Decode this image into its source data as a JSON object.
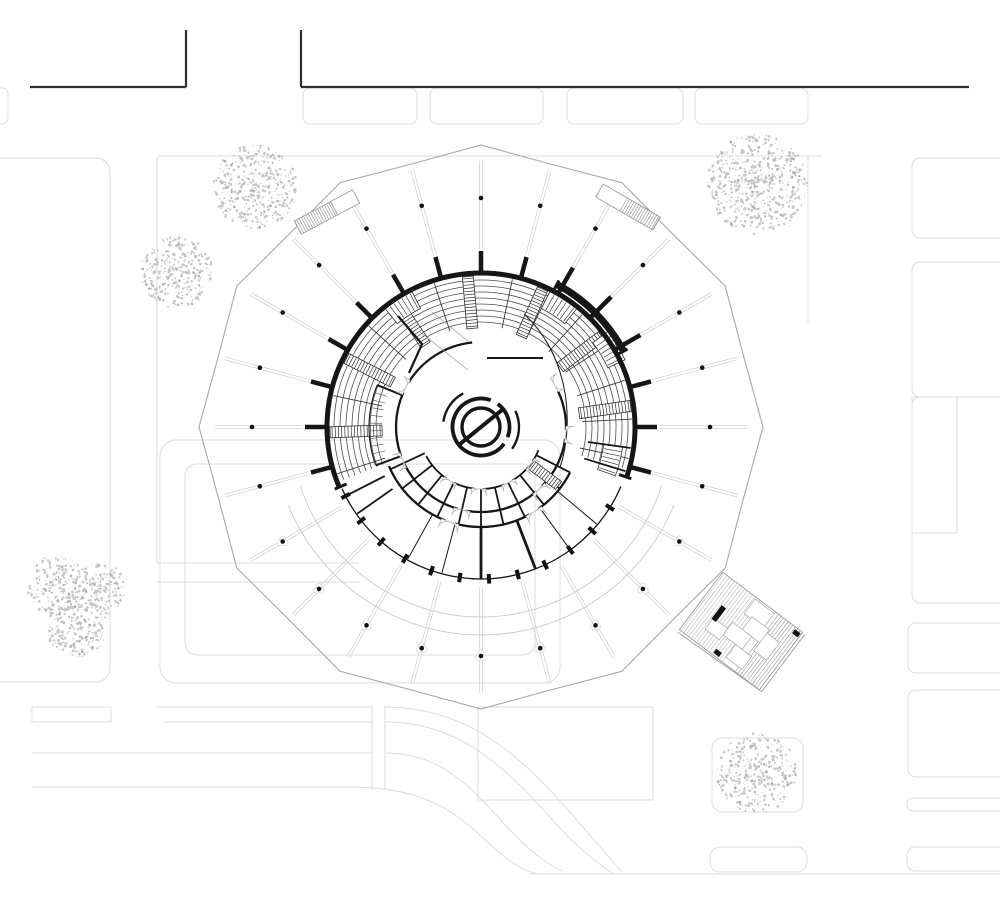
{
  "scene": {
    "canvas": {
      "w": 1000,
      "h": 913
    },
    "colors": {
      "ink": "#161616",
      "road": "#2f2f2f",
      "site": "#dcdcdc",
      "canopy": "#cfcfcf",
      "polygon": "#a8a8a8",
      "arc_faint": "#c9c9c9",
      "seat": "#4d4d4d",
      "sector": "#3a3a3a",
      "door": "#b5b5b5",
      "tree": "#c6c6c6",
      "tree_dark": "#b2b2b2",
      "annex": "#9a9a9a",
      "white": "#ffffff"
    },
    "center": {
      "x": 481,
      "y": 427
    },
    "roads": {
      "width": 2.2,
      "segments": [
        [
          30,
          87,
          186,
          87
        ],
        [
          186,
          30,
          186,
          87
        ],
        [
          301,
          30,
          301,
          87
        ],
        [
          301,
          87,
          969,
          87
        ]
      ]
    },
    "site": {
      "rrects": [
        [
          -14,
          88,
          22,
          36,
          6
        ],
        [
          303,
          88,
          114,
          36,
          7
        ],
        [
          430,
          88,
          113,
          36,
          7
        ],
        [
          567,
          88,
          116,
          36,
          7
        ],
        [
          695,
          88,
          113,
          36,
          7
        ],
        [
          912,
          158,
          96,
          80,
          8
        ],
        [
          912,
          262,
          96,
          135,
          8
        ],
        [
          912,
          397,
          96,
          206,
          8
        ],
        [
          908,
          623,
          100,
          50,
          8
        ],
        [
          908,
          690,
          100,
          87,
          8
        ],
        [
          907,
          798,
          100,
          13,
          6
        ],
        [
          907,
          847,
          100,
          24,
          8
        ],
        [
          -30,
          158,
          140,
          524,
          14
        ],
        [
          160,
          440,
          400,
          243,
          16
        ],
        [
          185,
          464,
          350,
          191,
          12
        ],
        [
          712,
          738,
          91,
          74,
          10
        ],
        [
          710,
          847,
          97,
          25,
          10
        ]
      ],
      "rects": [
        [
          912,
          397,
          45,
          136
        ],
        [
          478,
          707,
          175,
          93
        ],
        [
          32,
          707,
          79,
          15
        ]
      ],
      "lines": [
        [
          158,
          156,
          822,
          156
        ],
        [
          808,
          156,
          808,
          322
        ],
        [
          157,
          157,
          157,
          562
        ],
        [
          157,
          563,
          360,
          563
        ],
        [
          157,
          582,
          360,
          582
        ],
        [
          157,
          707,
          372,
          707
        ],
        [
          164,
          722,
          372,
          722
        ],
        [
          372,
          705,
          372,
          790
        ],
        [
          385,
          705,
          385,
          790
        ],
        [
          32,
          753,
          372,
          753
        ],
        [
          32,
          787,
          350,
          787
        ],
        [
          530,
          874,
          1008,
          874
        ]
      ],
      "paths": [
        "M385,707 C470,707 523,758 575,818 C598,845 610,858 622,872",
        "M385,722 C462,722 508,770 558,826 C580,850 596,862 612,873",
        "M385,753 C442,753 472,788 506,826 C530,852 546,863 562,871",
        "M350,787 C420,787 452,809 482,837 C506,860 522,871 538,874"
      ]
    },
    "canopy": {
      "polygonStep": 15,
      "rEven": 282,
      "rOdd": 272,
      "radials": {
        "rOut": 266,
        "rIn": 178,
        "rInGap": 160,
        "gapFrom": 205,
        "gapTo": 335,
        "offset": 1.4
      },
      "dots": {
        "r": 229,
        "size": 2.3,
        "rosetteFrom": 200,
        "rosetteTo": 340
      },
      "arcs": [
        [
          190,
          198,
          342
        ],
        [
          208,
          202,
          338
        ]
      ],
      "strips": [
        {
          "x": 327,
          "y": 212,
          "rot": -28,
          "hatch": [
            -33,
            8
          ]
        },
        {
          "x": 628,
          "y": 207,
          "rot": 30,
          "hatch": [
            -5,
            33
          ]
        }
      ]
    },
    "trees": [
      {
        "x": 255,
        "y": 187,
        "r": 42,
        "seed": 11
      },
      {
        "x": 177,
        "y": 272,
        "r": 36,
        "seed": 22
      },
      {
        "x": 757,
        "y": 184,
        "r": 50,
        "seed": 33
      },
      {
        "x": 57,
        "y": 585,
        "r": 30,
        "seed": 44
      },
      {
        "x": 99,
        "y": 589,
        "r": 27,
        "seed": 55
      },
      {
        "x": 77,
        "y": 628,
        "r": 30,
        "seed": 66
      },
      {
        "x": 757,
        "y": 773,
        "r": 40,
        "seed": 77
      }
    ],
    "building": {
      "wall": {
        "r": 154,
        "a0": -19,
        "a1": 203,
        "w": 5
      },
      "prot": {
        "r": 161.5,
        "a0": 28,
        "a1": 62,
        "w": 7
      },
      "protCaps": {
        "angles": [
          28,
          62
        ],
        "r0": 152,
        "r1": 166,
        "w": 3
      },
      "stubs": {
        "from": -15,
        "to": 200,
        "step": 15,
        "r0": 152,
        "r1": 176,
        "w": 4.5
      },
      "endCaps": {
        "angles": [
          -19,
          203
        ],
        "r0": 146,
        "r1": 159,
        "w": 3
      },
      "seatRows": {
        "radii": [
          105,
          111,
          117,
          123,
          129,
          135,
          141,
          147
        ],
        "a0": -16,
        "a1": 201,
        "w": 0.8
      },
      "sectorLines": {
        "from": -12,
        "to": 198,
        "step": 15,
        "r0": 101,
        "r1": 151,
        "w": 0.9
      },
      "ladders": {
        "angles": [
          8,
          37,
          66,
          95,
          124,
          153,
          182
        ],
        "r0": 99,
        "r1": 151,
        "hw": 5.5,
        "rung": 3.2
      },
      "bands": [
        {
          "a": 31,
          "r0": 140,
          "r1": 159
        },
        {
          "a": 57,
          "r0": 133,
          "r1": 152
        },
        {
          "a": 123,
          "r0": 133,
          "r1": 152
        },
        {
          "a": -14,
          "r0": 124,
          "r1": 143
        }
      ],
      "ring85": {
        "r": 85,
        "w": 2.3,
        "segs": [
          [
            96,
            148
          ],
          [
            156,
            200
          ],
          [
            206,
            254
          ],
          [
            260,
            310
          ],
          [
            316,
            352
          ],
          [
            358,
            385
          ]
        ]
      },
      "ring100": {
        "r": 100,
        "w": 2.3,
        "segs": [
          [
            203,
            249
          ],
          [
            255,
            299
          ],
          [
            305,
            333
          ]
        ]
      },
      "ring62": {
        "r": 62,
        "w": 1.8,
        "segs": [
          [
            208,
            236
          ],
          [
            244,
            264
          ],
          [
            272,
            292
          ],
          [
            300,
            320
          ],
          [
            326,
            338
          ]
        ]
      },
      "roomRadials": {
        "angles": [
          205,
          218,
          231,
          244,
          257,
          270,
          283,
          296,
          309,
          322,
          333
        ],
        "r0": 62,
        "r1": 100,
        "w": 1.8
      },
      "lowerWallsThick": {
        "angles": [
          270,
          291
        ],
        "r0": 100,
        "r1": 152,
        "w": 2.8
      },
      "lowerWallsThin": {
        "angles": [
          241,
          255,
          306,
          320
        ],
        "r0": 100,
        "r1": 151,
        "w": 1
      },
      "entryWalls": {
        "angles": [
          207,
          215,
          -17,
          -8
        ],
        "r0": 108,
        "r1": 151,
        "w": 1.8
      },
      "bottomArc": {
        "r": 152,
        "a0": 204,
        "a1": 337,
        "w": 1.3
      },
      "ticks": {
        "r": 152,
        "angles": [
          207,
          218,
          229,
          240,
          251,
          262,
          273,
          284,
          295,
          306,
          317,
          328
        ],
        "w": 4,
        "h": 9.5
      },
      "innerLadder": {
        "a": 323,
        "r0": 63,
        "r1": 97,
        "hw": 5,
        "rung": 3
      },
      "stallArc": {
        "r": 112,
        "a0": 158,
        "a1": 200,
        "w": 1.1
      },
      "stallRadials": {
        "from": 162,
        "to": 196,
        "step": 4,
        "r0": 99,
        "r1": 112,
        "w": 0.65
      },
      "stallSides": {
        "angles": [
          158,
          200
        ],
        "r0": 85,
        "r1": 112,
        "w": 2
      },
      "pocketPath": "M398,316 L422,344 L409,373",
      "chordPath": "M487,358 L543,358",
      "curvePath": "M524,314 C566,352 576,418 560,468",
      "faintPaths": [
        "M420,332 L468,370",
        "M432,312 L469,342"
      ],
      "doors": [
        [
          85,
          152,
          8
        ],
        [
          85,
          203,
          8
        ],
        [
          85,
          257,
          8
        ],
        [
          85,
          313,
          8
        ],
        [
          85,
          355,
          8
        ],
        [
          85,
          30,
          8
        ],
        [
          62,
          240,
          7
        ],
        [
          62,
          268,
          7
        ],
        [
          62,
          296,
          7
        ],
        [
          62,
          323,
          7
        ],
        [
          100,
          252,
          9
        ],
        [
          100,
          302,
          9
        ]
      ],
      "emblem": {
        "ringR": 28.5,
        "ringW": 3.8,
        "ringSegs": [
          [
            70,
            324
          ],
          [
            339,
            414
          ]
        ],
        "innerR": 19,
        "innerW": 3.4,
        "slashA": 39,
        "slashR": 29.5,
        "slashW": 4,
        "r38segs": [
          [
            118,
            172
          ],
          [
            -35,
            25
          ]
        ],
        "r38w": 2.4
      }
    },
    "annex": {
      "x": 741,
      "y": 631,
      "rot": 37,
      "w": 100,
      "h": 72,
      "hatchL": {
        "x0": -48,
        "x1": 6,
        "step": 3.2
      },
      "hatchR": {
        "x0": 20,
        "x1": 48,
        "step": 3.0
      },
      "rooms": [
        [
          -8,
          -34,
          24,
          18
        ],
        [
          0,
          -18,
          22,
          16
        ],
        [
          -12,
          -2,
          24,
          16
        ],
        [
          4,
          14,
          20,
          16
        ],
        [
          22,
          -14,
          16,
          22
        ],
        [
          -30,
          6,
          18,
          14
        ]
      ],
      "bar": [
        -31,
        -9,
        5.5,
        17
      ],
      "squares": [
        [
          42,
          -34,
          7,
          5
        ],
        [
          -9,
          29,
          7,
          5
        ]
      ],
      "edgePath": "M53,-36 L53,36 L-50,39"
    }
  }
}
